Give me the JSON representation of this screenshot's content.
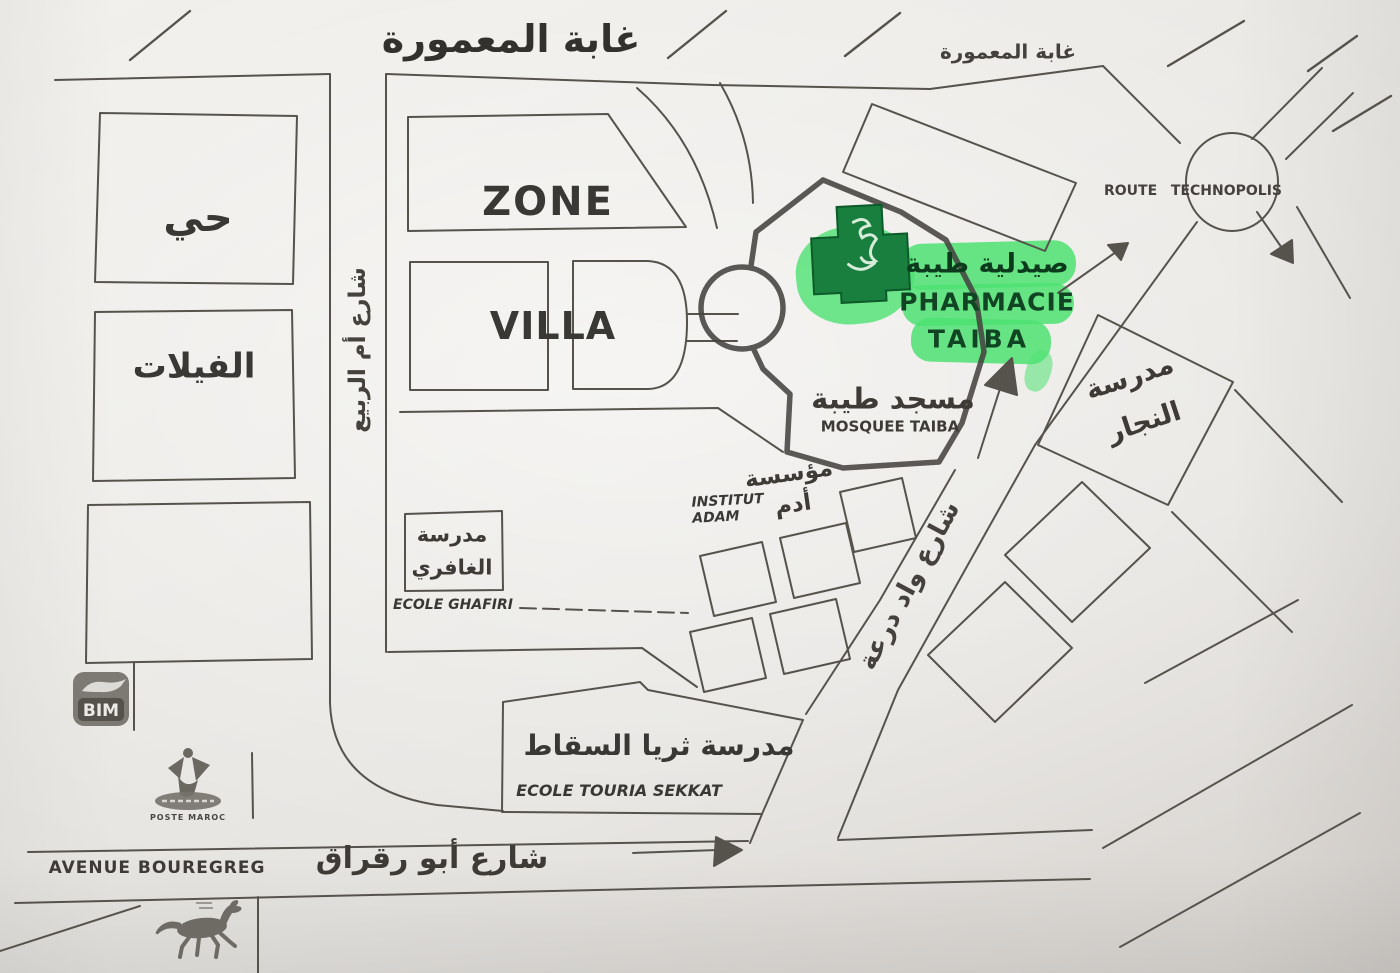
{
  "colors": {
    "highlight_green": "#4ee272",
    "cross_green": "#187f3e",
    "ink": "#55524c",
    "paper": "#eae8e4"
  },
  "forest": {
    "title": "غابة المعمورة",
    "title_right": "غابة المعمورة"
  },
  "districts": {
    "hay": "حي",
    "villas": "الفيلات",
    "zone": "ZONE",
    "villa": "VILLA"
  },
  "streets": {
    "oum_rabii": "شارع أم الربيع",
    "oued_daraa": "شارع واد درعة",
    "avenue_fr": "AVENUE BOUREGREG",
    "avenue_ar": "شارع أبو رقراق",
    "route": "ROUTE",
    "technopolis": "TECHNOPOLIS"
  },
  "pharmacy": {
    "name_ar": "صيدلية طيبة",
    "name_fr_line1": "PHARMACIE",
    "name_fr_line2": "TAIBA"
  },
  "mosque": {
    "name_ar": "مسجد طيبة",
    "name_fr": "MOSQUEE TAIBA"
  },
  "schools": {
    "najjar_line1": "مدرسة",
    "najjar_line2": "النجار",
    "ghafiri_line1": "مدرسة",
    "ghafiri_line2": "الغافري",
    "ghafiri_fr": "ECOLE GHAFIRI",
    "institut_ar_line1": "مؤسسة",
    "institut_ar_line2": "أدم",
    "institut_fr_line1": "INSTITUT",
    "institut_fr_line2": "ADAM",
    "sekkat_ar": "مدرسة ثريا السقاط",
    "sekkat_fr": "ECOLE TOURIA  SEKKAT"
  },
  "logos": {
    "bim": "BIM",
    "poste": "POSTE MAROC"
  }
}
